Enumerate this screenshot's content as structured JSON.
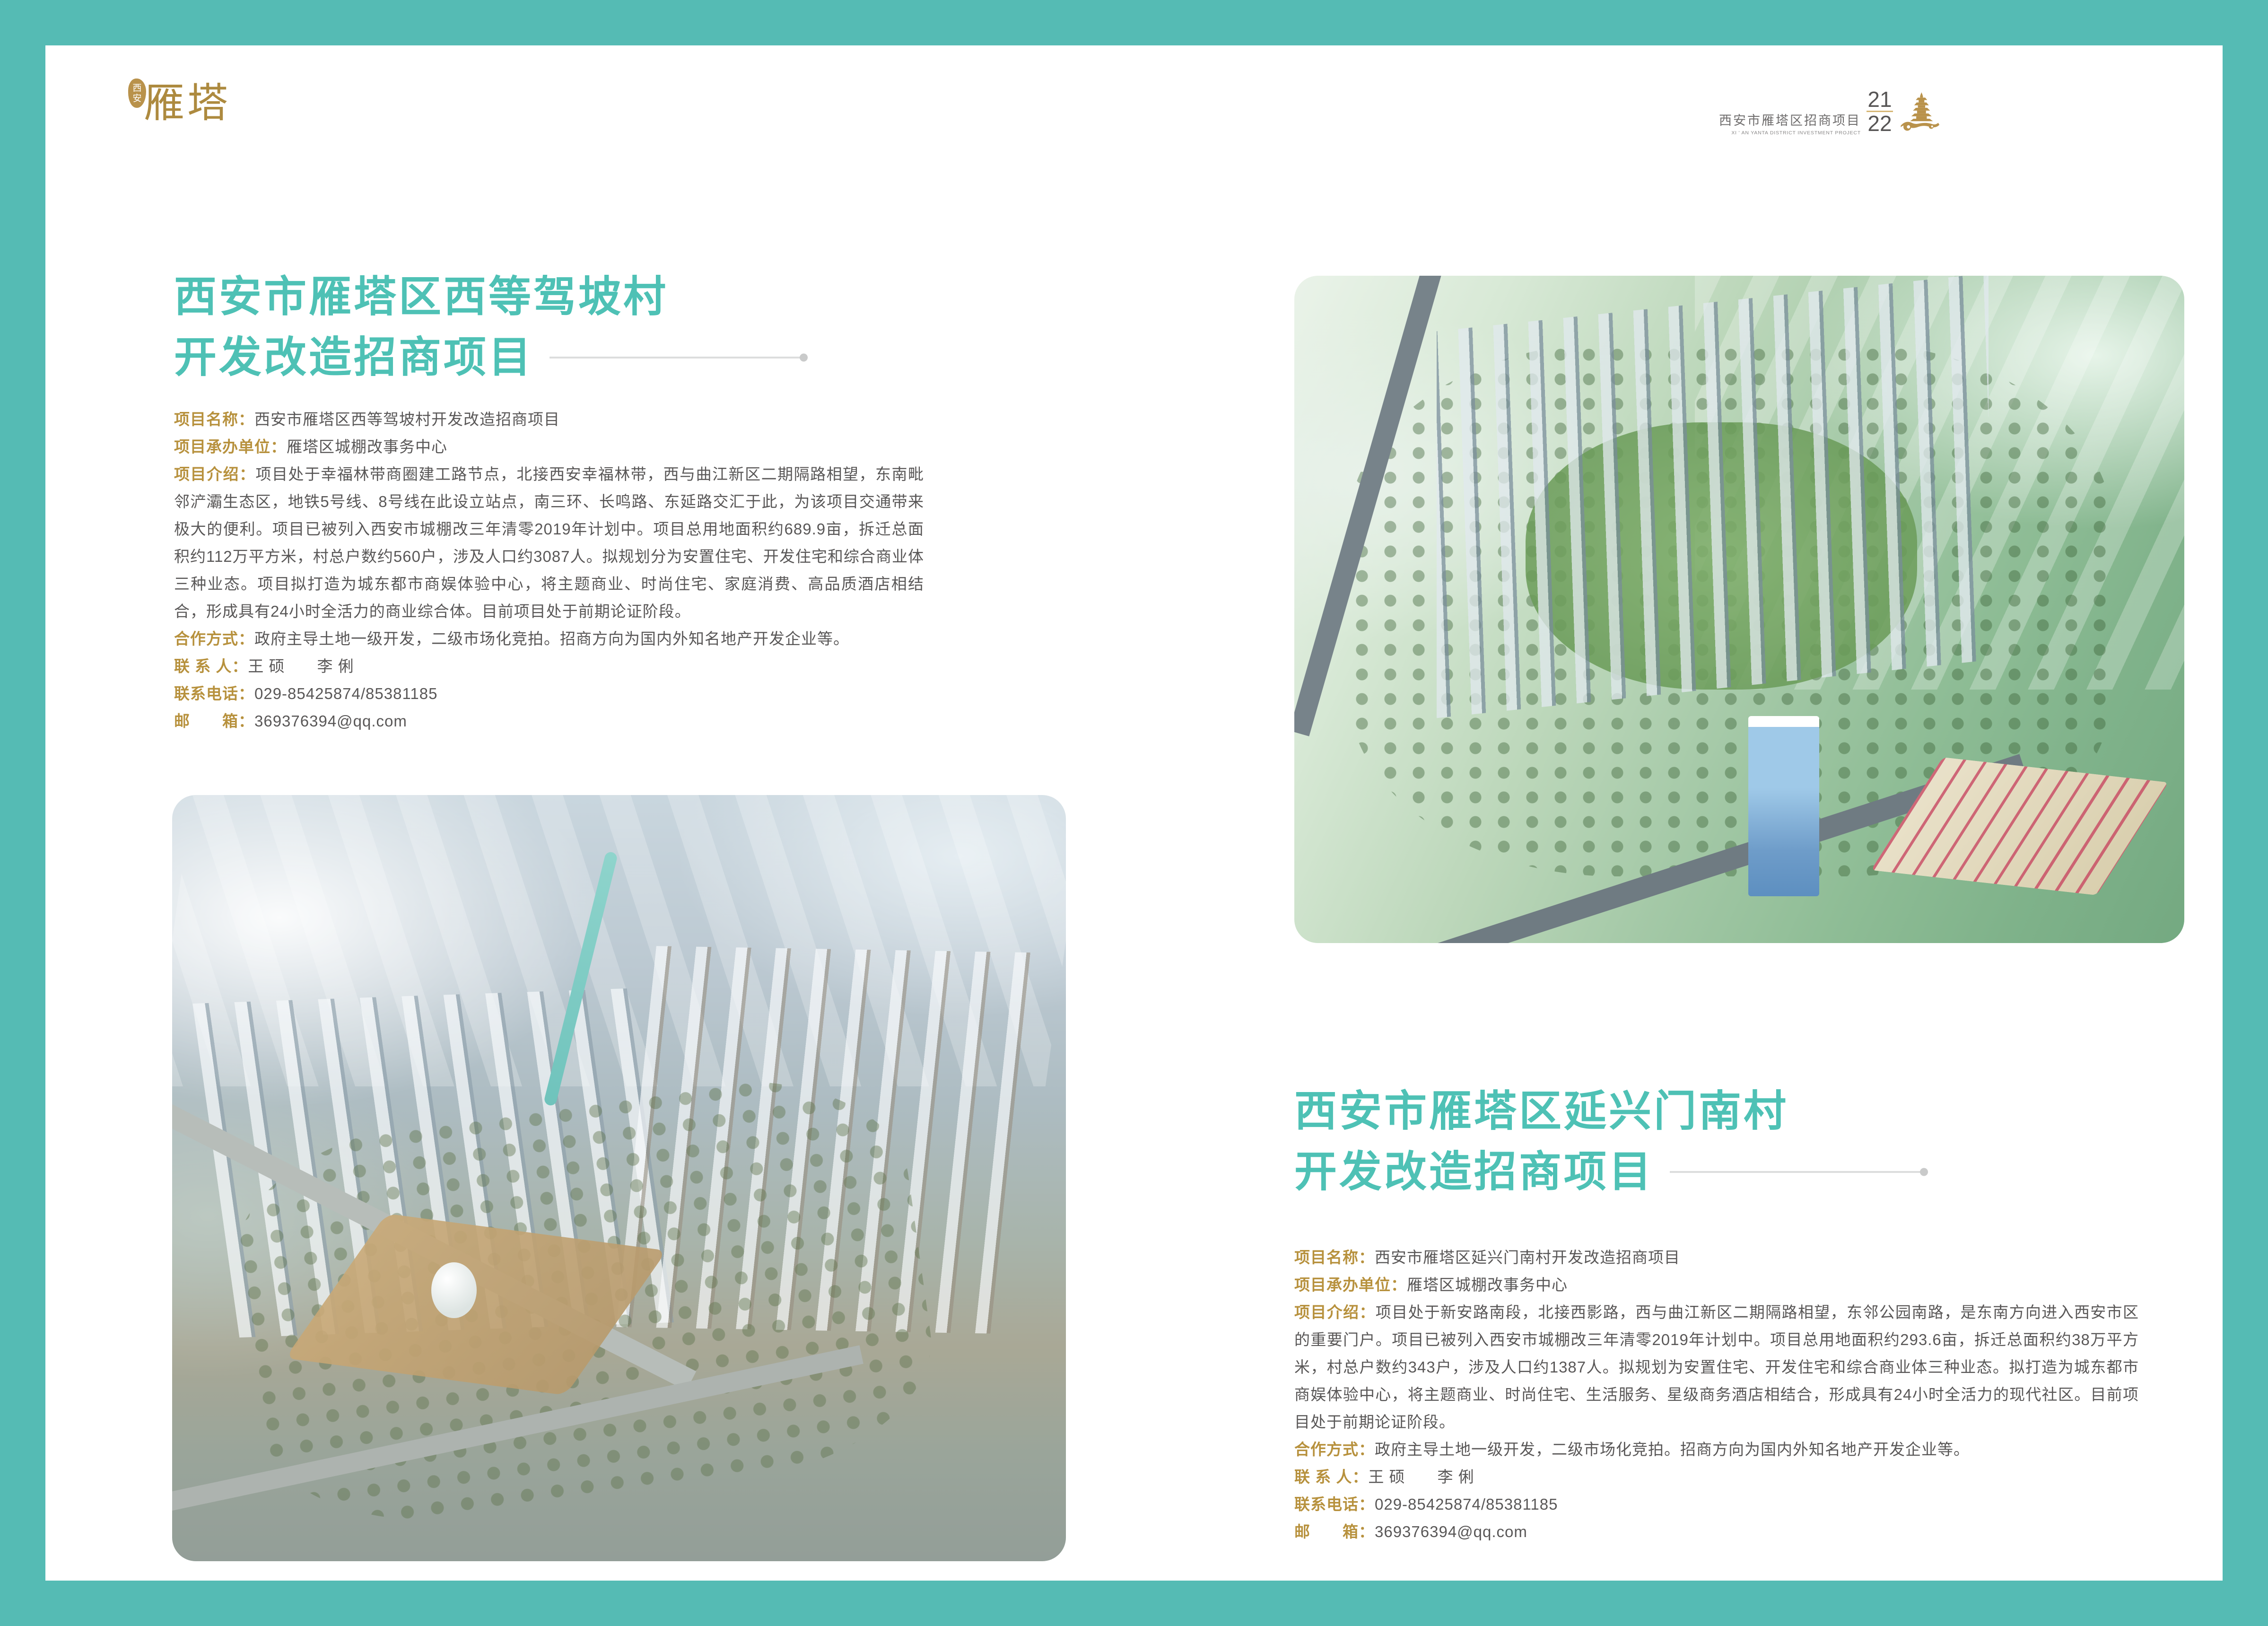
{
  "page": {
    "colors": {
      "frame_teal": "#55bbb4",
      "title_teal": "#4ec1b5",
      "label_gold": "#b7913d",
      "logo_gold": "#ad8a3f",
      "body_gray": "#595757",
      "header_gray": "#6f6d6d",
      "divider_gray": "#dcdddd",
      "page_rule_gold": "#d7b776"
    }
  },
  "logo": {
    "seal_char_top": "西",
    "seal_char_bottom": "安",
    "wordmark": "雁塔"
  },
  "header": {
    "title_cn": "西安市雁塔区招商项目",
    "title_en": "XI ' AN YANTA DISTRICT  INVESTMENT PROJECT",
    "page_current": "21",
    "page_total": "22",
    "pagoda_icon": "pagoda-cloud-icon"
  },
  "left_project": {
    "title_line1": "西安市雁塔区西等驾坡村",
    "title_line2": "开发改造招商项目",
    "fields": [
      {
        "label": "项目名称：",
        "value": "西安市雁塔区西等驾坡村开发改造招商项目"
      },
      {
        "label": "项目承办单位：",
        "value": "雁塔区城棚改事务中心"
      },
      {
        "label": "项目介绍：",
        "value": "项目处于幸福林带商圈建工路节点，北接西安幸福林带，西与曲江新区二期隔路相望，东南毗邻浐灞生态区，地铁5号线、8号线在此设立站点，南三环、长鸣路、东延路交汇于此，为该项目交通带来极大的便利。项目已被列入西安市城棚改三年清零2019年计划中。项目总用地面积约689.9亩，拆迁总面积约112万平方米，村总户数约560户，涉及人口约3087人。拟规划分为安置住宅、开发住宅和综合商业体三种业态。项目拟打造为城东都市商娱体验中心，将主题商业、时尚住宅、家庭消费、高品质酒店相结合，形成具有24小时全活力的商业综合体。目前项目处于前期论证阶段。"
      },
      {
        "label": "合作方式：",
        "value": "政府主导土地一级开发，二级市场化竞拍。招商方向为国内外知名地产开发企业等。"
      },
      {
        "label": "联 系 人：",
        "value": "王 硕　　李 俐"
      },
      {
        "label": "联系电话：",
        "value": "029-85425874/85381185"
      },
      {
        "label": "邮　　箱：",
        "value": "369376394@qq.com"
      }
    ]
  },
  "right_project": {
    "title_line1": "西安市雁塔区延兴门南村",
    "title_line2": "开发改造招商项目",
    "fields": [
      {
        "label": "项目名称：",
        "value": "西安市雁塔区延兴门南村开发改造招商项目"
      },
      {
        "label": "项目承办单位：",
        "value": "雁塔区城棚改事务中心"
      },
      {
        "label": "项目介绍：",
        "value": "项目处于新安路南段，北接西影路，西与曲江新区二期隔路相望，东邻公园南路，是东南方向进入西安市区的重要门户。项目已被列入西安市城棚改三年清零2019年计划中。项目总用地面积约293.6亩，拆迁总面积约38万平方米，村总户数约343户，涉及人口约1387人。拟规划为安置住宅、开发住宅和综合商业体三种业态。拟打造为城东都市商娱体验中心，将主题商业、时尚住宅、生活服务、星级商务酒店相结合，形成具有24小时全活力的现代社区。目前项目处于前期论证阶段。"
      },
      {
        "label": "合作方式：",
        "value": "政府主导土地一级开发，二级市场化竞拍。招商方向为国内外知名地产开发企业等。"
      },
      {
        "label": "联 系 人：",
        "value": "王 硕　　李 俐"
      },
      {
        "label": "联系电话：",
        "value": "029-85425874/85381185"
      },
      {
        "label": "邮　　箱：",
        "value": "369376394@qq.com"
      }
    ]
  }
}
